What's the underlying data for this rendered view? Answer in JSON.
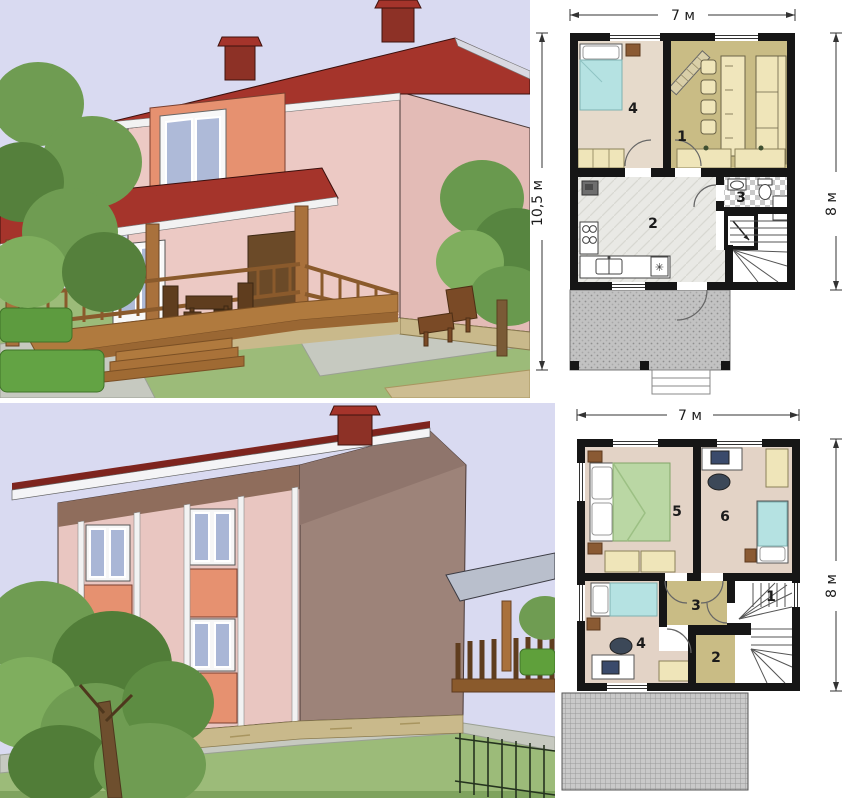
{
  "plan_first_floor": {
    "dim_top": "7 м",
    "dim_left": "10,5 м",
    "dim_right": "8 м",
    "rooms": [
      {
        "number": "1"
      },
      {
        "number": "2"
      },
      {
        "number": "3"
      },
      {
        "number": "4"
      }
    ],
    "kitchen_boiler_symbol": "✳"
  },
  "plan_second_floor": {
    "dim_top": "7 м",
    "dim_right": "8 м",
    "rooms": [
      {
        "number": "1"
      },
      {
        "number": "2"
      },
      {
        "number": "3"
      },
      {
        "number": "4"
      },
      {
        "number": "5"
      },
      {
        "number": "6"
      }
    ]
  },
  "colors": {
    "sky": "#d9daf1",
    "wall_pink": "#ecc9c4",
    "accent_salmon": "#e69170",
    "roof_red": "#a5342b",
    "chimney_red": "#8d3126",
    "wood_brown": "#a9713c",
    "dark_wood": "#5f3d1e",
    "grass_green": "#9cbb79",
    "paving_gray": "#c6c9c0",
    "foundation_tan": "#c9b98b",
    "floor_olive": "#c9bc85",
    "floor_beige": "#e4d6c8",
    "furniture_cream": "#efe5b9",
    "bed_teal": "#b5e2e2",
    "bed_green": "#bad7a4",
    "plan_wall_black": "#161616"
  }
}
